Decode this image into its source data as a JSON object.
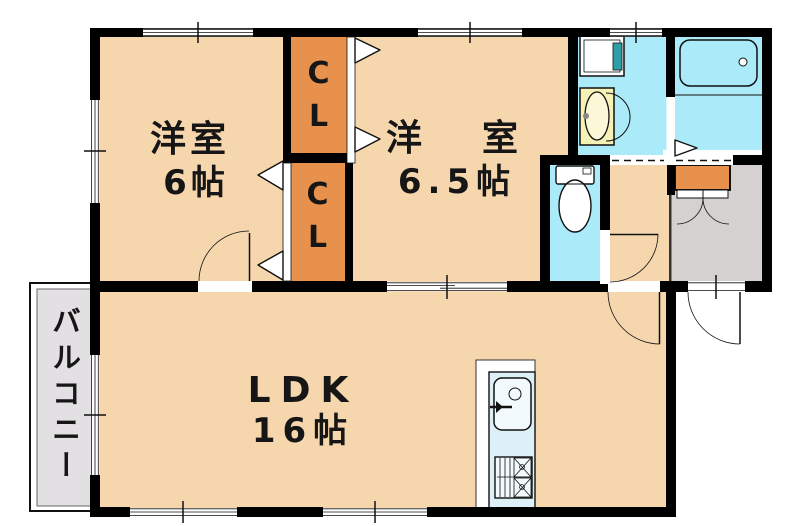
{
  "palette": {
    "wall": "#000000",
    "peach": "#f6d6ad",
    "orange": "#e8914c",
    "cyan": "#abeaf8",
    "teal": "#2d9fa6",
    "yellow": "#f6f2b6",
    "genkan": "#d6d1d1",
    "balcony": "#e3e0e3",
    "kitchen": "#ddeff7"
  },
  "rooms": {
    "bedroom1": {
      "name": "洋室",
      "size": "6帖"
    },
    "bedroom2": {
      "name": "洋　室",
      "size": "6.5帖"
    },
    "ldk": {
      "name": "LDK",
      "size": "16帖"
    },
    "balcony": {
      "name": "バルコニー"
    },
    "closet_upper": {
      "label": "CL"
    },
    "closet_lower": {
      "label": "CL"
    }
  }
}
